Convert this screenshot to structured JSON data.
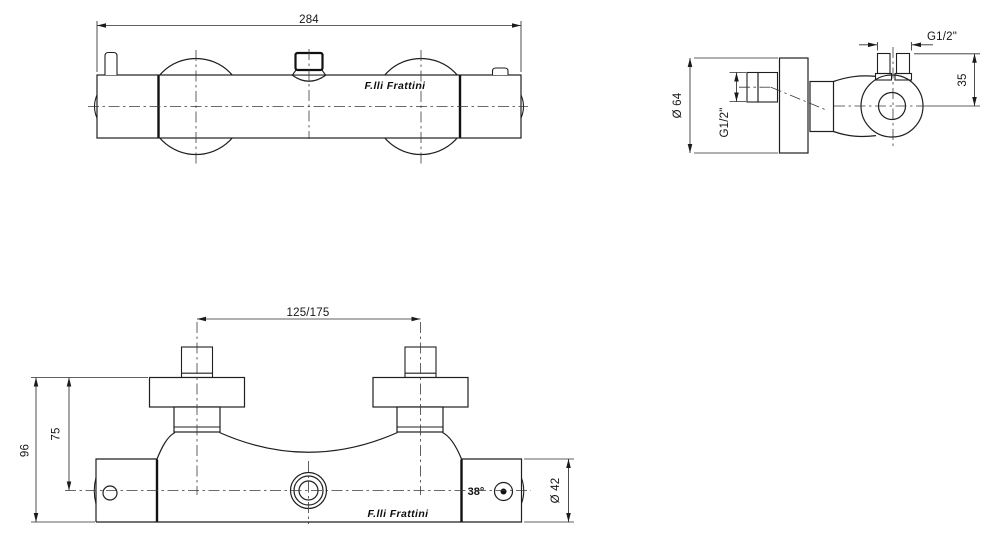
{
  "brand": "F.lli Frattini",
  "dims": {
    "overall_width": "284",
    "outlet_thread": "G1/2\"",
    "outlet_height": "35",
    "flange_diameter": "Ø 64",
    "inlet_thread": "G1/2\"",
    "union_centers": "125/175",
    "total_height": "96",
    "centerline_height": "75",
    "body_diameter": "Ø 42",
    "temperature_stop": "38°"
  }
}
